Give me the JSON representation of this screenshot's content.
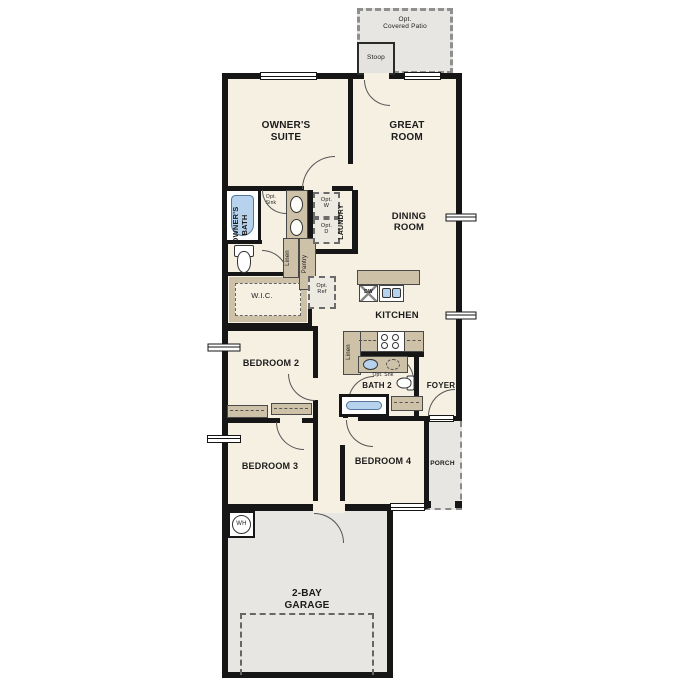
{
  "colors": {
    "wall": "#161616",
    "floor": "#f6f0e3",
    "fixture_tan": "#cdc1a8",
    "outdoor_gray": "#e7e6e2",
    "water_blue": "#b7d2ec",
    "optional_dash": "#6b6b6b"
  },
  "labels": {
    "patio": "Opt.\nCovered Patio",
    "stoop": "Stoop",
    "owners_suite": "OWNER'S\nSUITE",
    "great_room": "GREAT\nROOM",
    "owners_bath": "OWNER'S\nBATH",
    "opt_sink": "Opt.\nSink",
    "opt_washer": "Opt.\nW",
    "opt_dryer": "Opt.\nD",
    "laundry": "LAUNDRY",
    "linen": "Linen",
    "pantry": "Pantry",
    "dining_room": "DINING\nROOM",
    "wic": "W.I.C.",
    "opt_ref": "Opt.\nRef",
    "kitchen": "KITCHEN",
    "dishwasher": "DW",
    "bedroom_2": "BEDROOM 2",
    "opt_snk": "Opt. Snk",
    "bath_2": "BATH 2",
    "foyer": "FOYER",
    "bedroom_3": "BEDROOM 3",
    "bedroom_4": "BEDROOM 4",
    "porch": "PORCH",
    "water_heater": "WH",
    "garage": "2-BAY\nGARAGE"
  }
}
